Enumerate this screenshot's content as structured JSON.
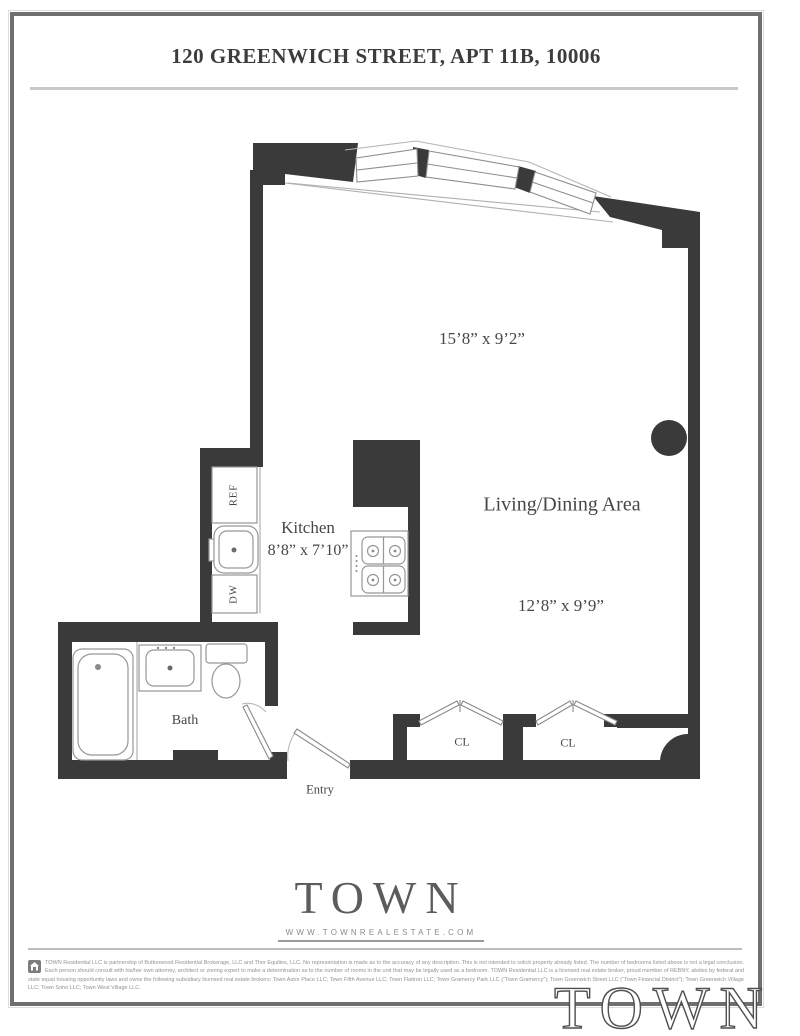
{
  "page": {
    "title": "120 GREENWICH STREET, APT 11B, 10006"
  },
  "plan": {
    "labels": {
      "dim_top": "15’8” x 9’2”",
      "living": "Living/Dining Area",
      "dim_living": "12’8” x 9’9”",
      "kitchen": "Kitchen",
      "dim_kitchen": "8’8” x 7’10”",
      "ref": "REF",
      "dw": "DW",
      "bath": "Bath",
      "closet_left": "CL",
      "closet_right": "CL",
      "entry": "Entry"
    }
  },
  "footer": {
    "logo": "TOWN",
    "website": "WWW.TOWNREALESTATE.COM",
    "watermark": "TOWN",
    "disclaimer_lines": "TOWN Residential LLC is partnership of Buttonwood Residential Brokerage, LLC and Thor Equities, LLC. No representation is made as to the accuracy of any description. This is not intended to solicit property already listed. The number of bedrooms listed above is not a legal conclusion. Each person should consult with his/her own attorney, architect or zoning expert to make a determination as to the number of rooms in the unit that may be legally used as a bedroom. TOWN Residential LLC is a licensed real estate broker, proud member of REBNY, abides by federal and state equal housing opportunity laws and owns the following subsidiary licensed real estate brokers: Town Astor Place LLC; Town Fifth Avenue LLC; Town Flatiron LLC; Town Gramercy Park LLC (“Town Gramercy”); Town Greenwich Street LLC (“Town Financial District”); Town Greenwich Village LLC; Town Soho LLC; Town West Village LLC."
  },
  "colors": {
    "wall": "#3a3a3a",
    "fixture_stroke": "#979797",
    "text": "#474747",
    "frame": "#6f6f6f"
  }
}
